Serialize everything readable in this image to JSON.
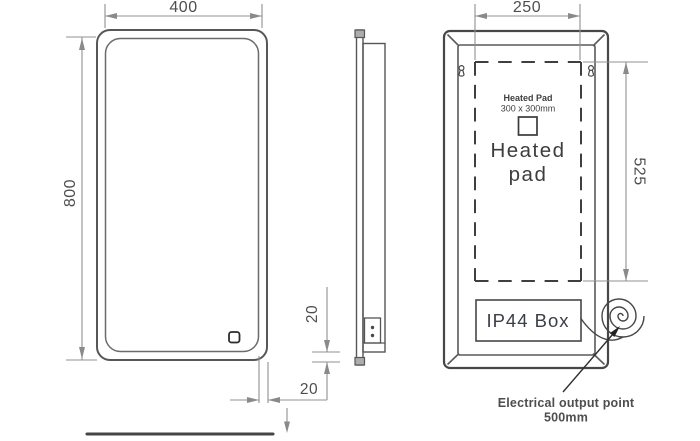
{
  "front_view": {
    "width_label": "400",
    "height_label": "800",
    "inset_right_label": "20",
    "inset_bottom_label": "20"
  },
  "back_view": {
    "pad_width_label": "250",
    "pad_height_label": "525",
    "pad_note_title": "Heated Pad",
    "pad_note_size": "300 x 300mm",
    "pad_word_top": "Heated",
    "pad_word_bottom": "pad",
    "ip44_label": "IP44 Box"
  },
  "annotation": {
    "line1": "Electrical output point",
    "line2": "500mm",
    "color": "#e8434e"
  }
}
